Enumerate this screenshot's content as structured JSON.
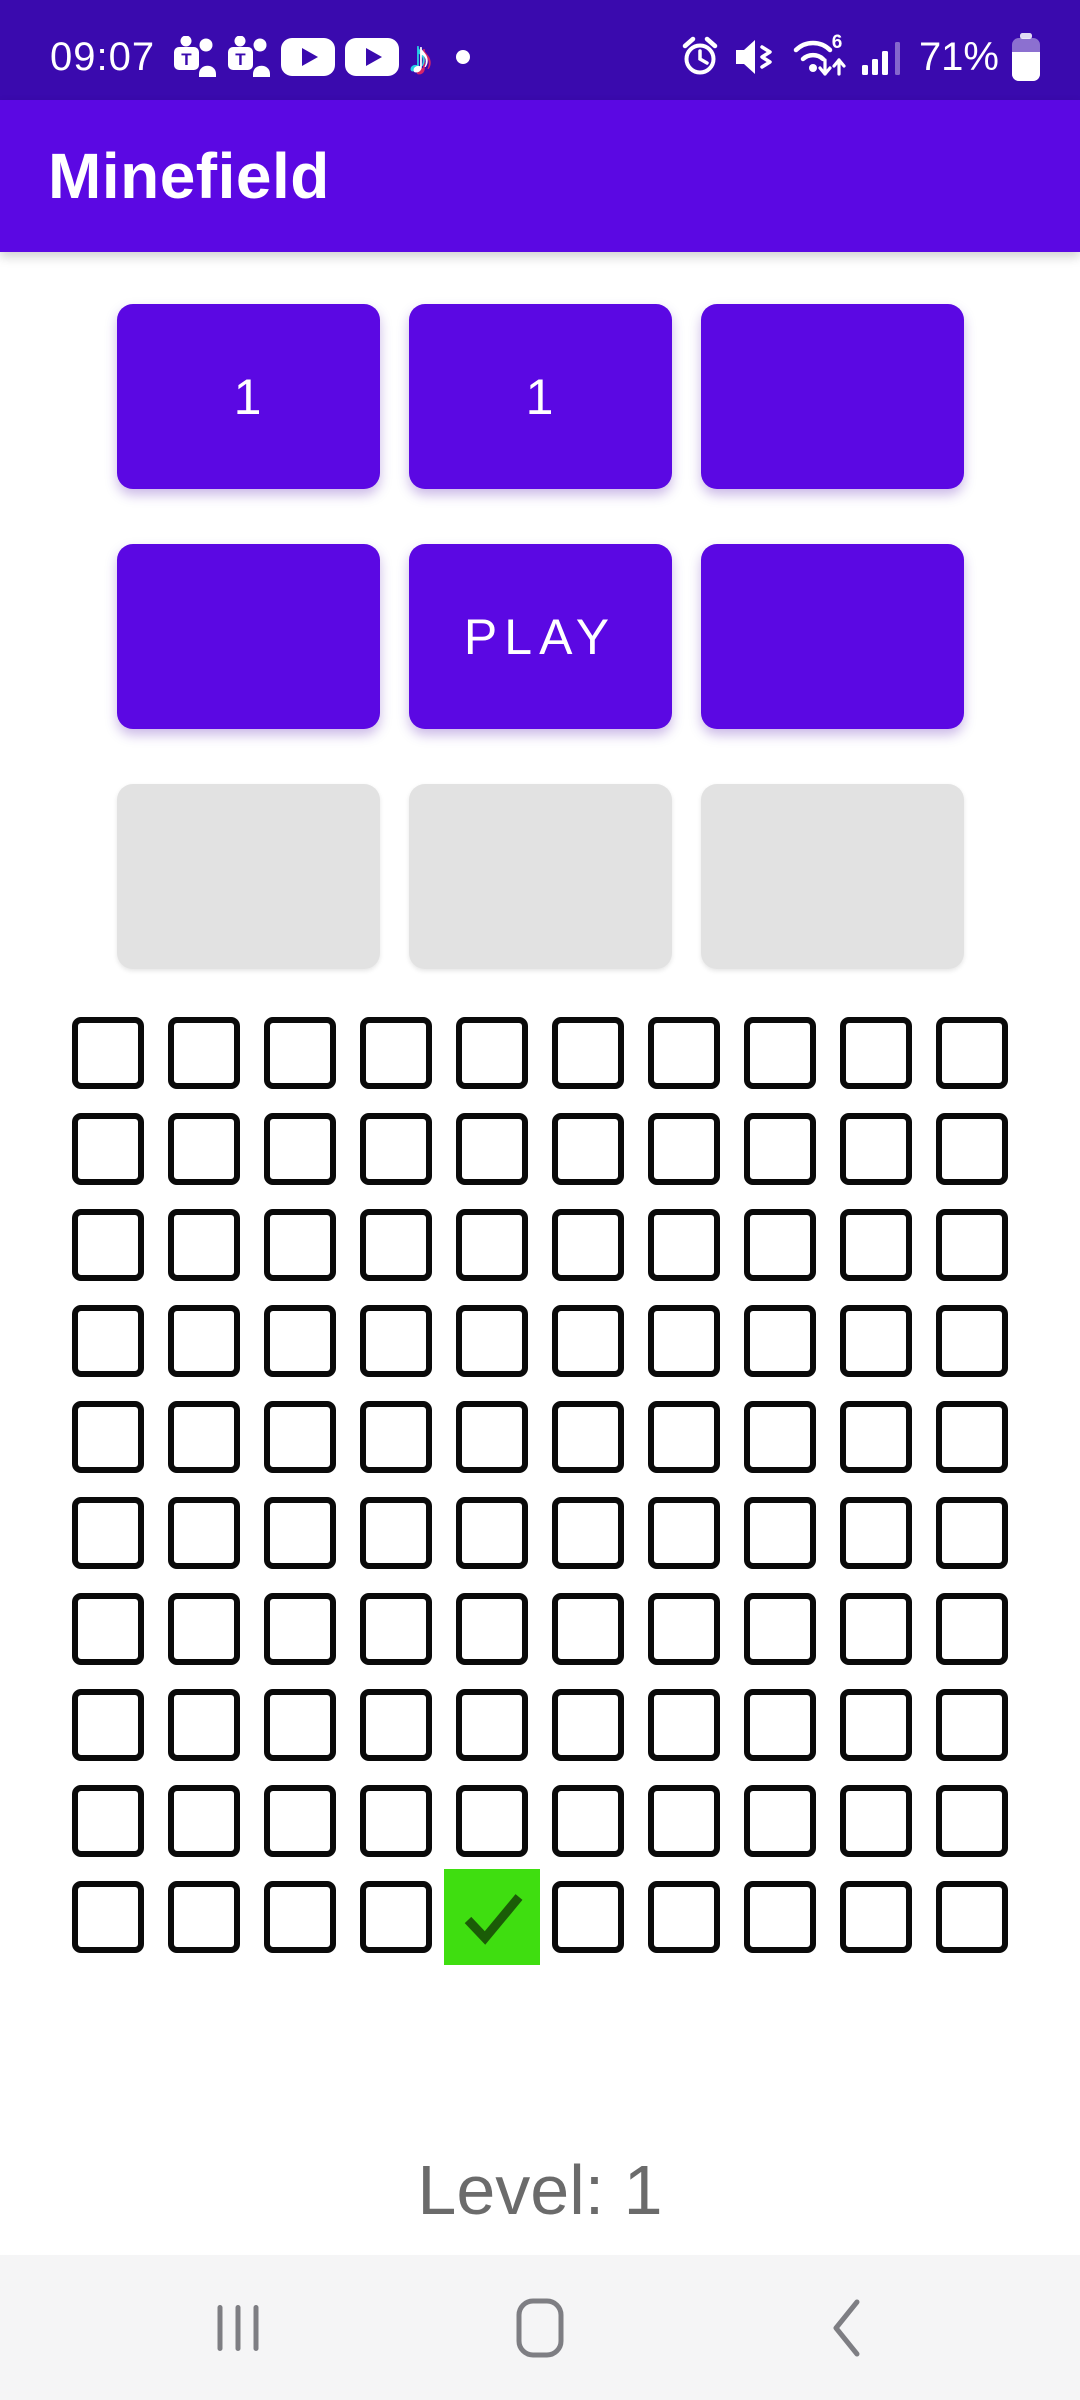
{
  "status_bar": {
    "time": "09:07",
    "battery_level": "71%",
    "background_color": "#3A0AAE",
    "notification_icons": [
      {
        "name": "teams-icon"
      },
      {
        "name": "teams-icon"
      },
      {
        "name": "youtube-icon"
      },
      {
        "name": "youtube-icon"
      },
      {
        "name": "tiktok-icon"
      },
      {
        "name": "notification-dot"
      }
    ],
    "system_icons": [
      {
        "name": "alarm-icon"
      },
      {
        "name": "volume-muted-icon"
      },
      {
        "name": "wifi6-icon"
      },
      {
        "name": "signal-strength-icon"
      },
      {
        "name": "battery-icon"
      }
    ]
  },
  "app_bar": {
    "title": "Minefield",
    "background_color": "#5B08E3"
  },
  "control_buttons": {
    "button_color": "#5B08E3",
    "disabled_color": "#E2E2E2",
    "text_color": "#FFFFFF",
    "row1": [
      {
        "label": "1",
        "disabled": false
      },
      {
        "label": "1",
        "disabled": false
      },
      {
        "label": "",
        "disabled": false
      }
    ],
    "row2": [
      {
        "label": "",
        "disabled": false
      },
      {
        "label": "PLAY",
        "disabled": false
      },
      {
        "label": "",
        "disabled": false
      }
    ],
    "row3": [
      {
        "label": "",
        "disabled": true
      },
      {
        "label": "",
        "disabled": true
      },
      {
        "label": "",
        "disabled": true
      }
    ]
  },
  "mine_grid": {
    "rows": 10,
    "cols": 10,
    "checked_cells": [
      {
        "row": 10,
        "col": 5
      }
    ],
    "checked_background": "#3FDE10",
    "checkmark_color": "#1B5C07",
    "box_border_color": "#0A0A0A"
  },
  "status_text": {
    "level_label": "Level: 1"
  },
  "nav_bar": {
    "icons": [
      {
        "name": "recents-icon"
      },
      {
        "name": "home-icon"
      },
      {
        "name": "back-icon"
      }
    ]
  }
}
